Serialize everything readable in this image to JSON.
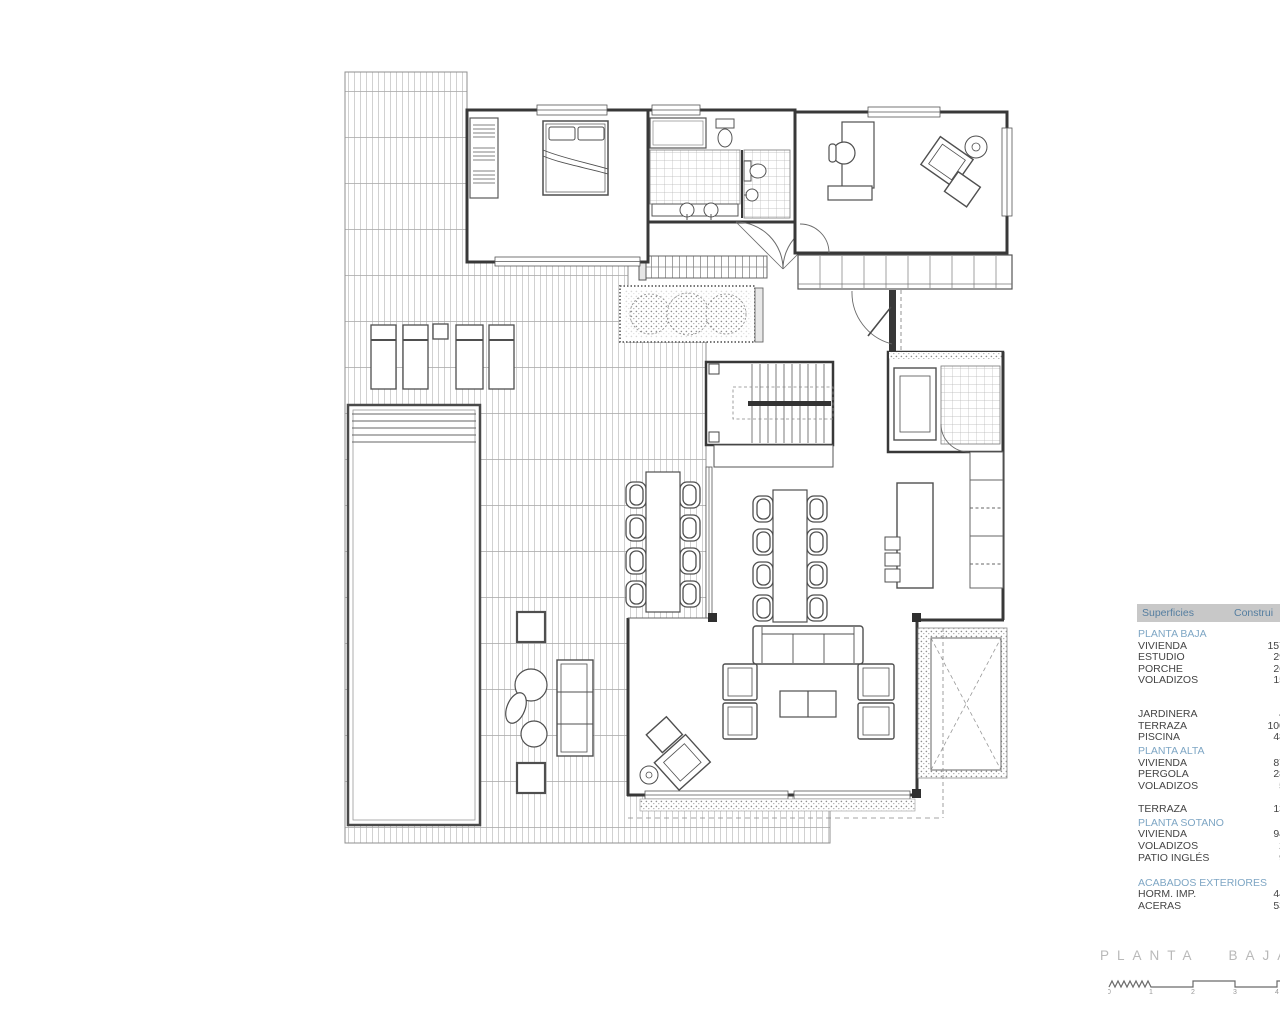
{
  "plan": {
    "title": "PLANTA BAJA"
  },
  "surfaces_table": {
    "header": {
      "col1": "Superficies",
      "col2": "Construi"
    },
    "rows": [
      {
        "type": "section",
        "label": "PLANTA BAJA"
      },
      {
        "type": "item",
        "label": "VIVIENDA",
        "value": "157"
      },
      {
        "type": "item",
        "label": "ESTUDIO",
        "value": "29"
      },
      {
        "type": "item",
        "label": "PORCHE",
        "value": "26"
      },
      {
        "type": "item",
        "label": "VOLADIZOS",
        "value": "15"
      },
      {
        "type": "spacer"
      },
      {
        "type": "spacer"
      },
      {
        "type": "item",
        "label": "JARDINERA",
        "value": "4"
      },
      {
        "type": "item",
        "label": "TERRAZA",
        "value": "100"
      },
      {
        "type": "item",
        "label": "PISCINA",
        "value": "48"
      },
      {
        "type": "section",
        "label": "PLANTA ALTA"
      },
      {
        "type": "item",
        "label": "VIVIENDA",
        "value": "87"
      },
      {
        "type": "item",
        "label": "PERGOLA",
        "value": "28"
      },
      {
        "type": "item",
        "label": "VOLADIZOS",
        "value": "5"
      },
      {
        "type": "spacer"
      },
      {
        "type": "item",
        "label": "TERRAZA",
        "value": "13"
      },
      {
        "type": "section",
        "label": "PLANTA SOTANO"
      },
      {
        "type": "item",
        "label": "VIVIENDA",
        "value": "94"
      },
      {
        "type": "item",
        "label": "VOLADIZOS",
        "value": "2"
      },
      {
        "type": "item",
        "label": "PATIO INGLÉS",
        "value": "9"
      },
      {
        "type": "spacer"
      },
      {
        "type": "section",
        "label": "ACABADOS EXTERIORES"
      },
      {
        "type": "item",
        "label": "HORM. IMP.",
        "value": "44"
      },
      {
        "type": "item",
        "label": "ACERAS",
        "value": "53"
      }
    ]
  },
  "scale_bar": {
    "labels": [
      "0",
      "1",
      "2",
      "3",
      "4"
    ]
  },
  "colors": {
    "table_header_bg": "#c8c8c8",
    "table_header_text": "#557ea0",
    "section_text": "#7ea6c4",
    "body_text": "#444444",
    "title_text": "#b9b9b9",
    "wall_line": "#383838",
    "thin_line": "#666666",
    "hatch_line": "#c6c6c6"
  }
}
